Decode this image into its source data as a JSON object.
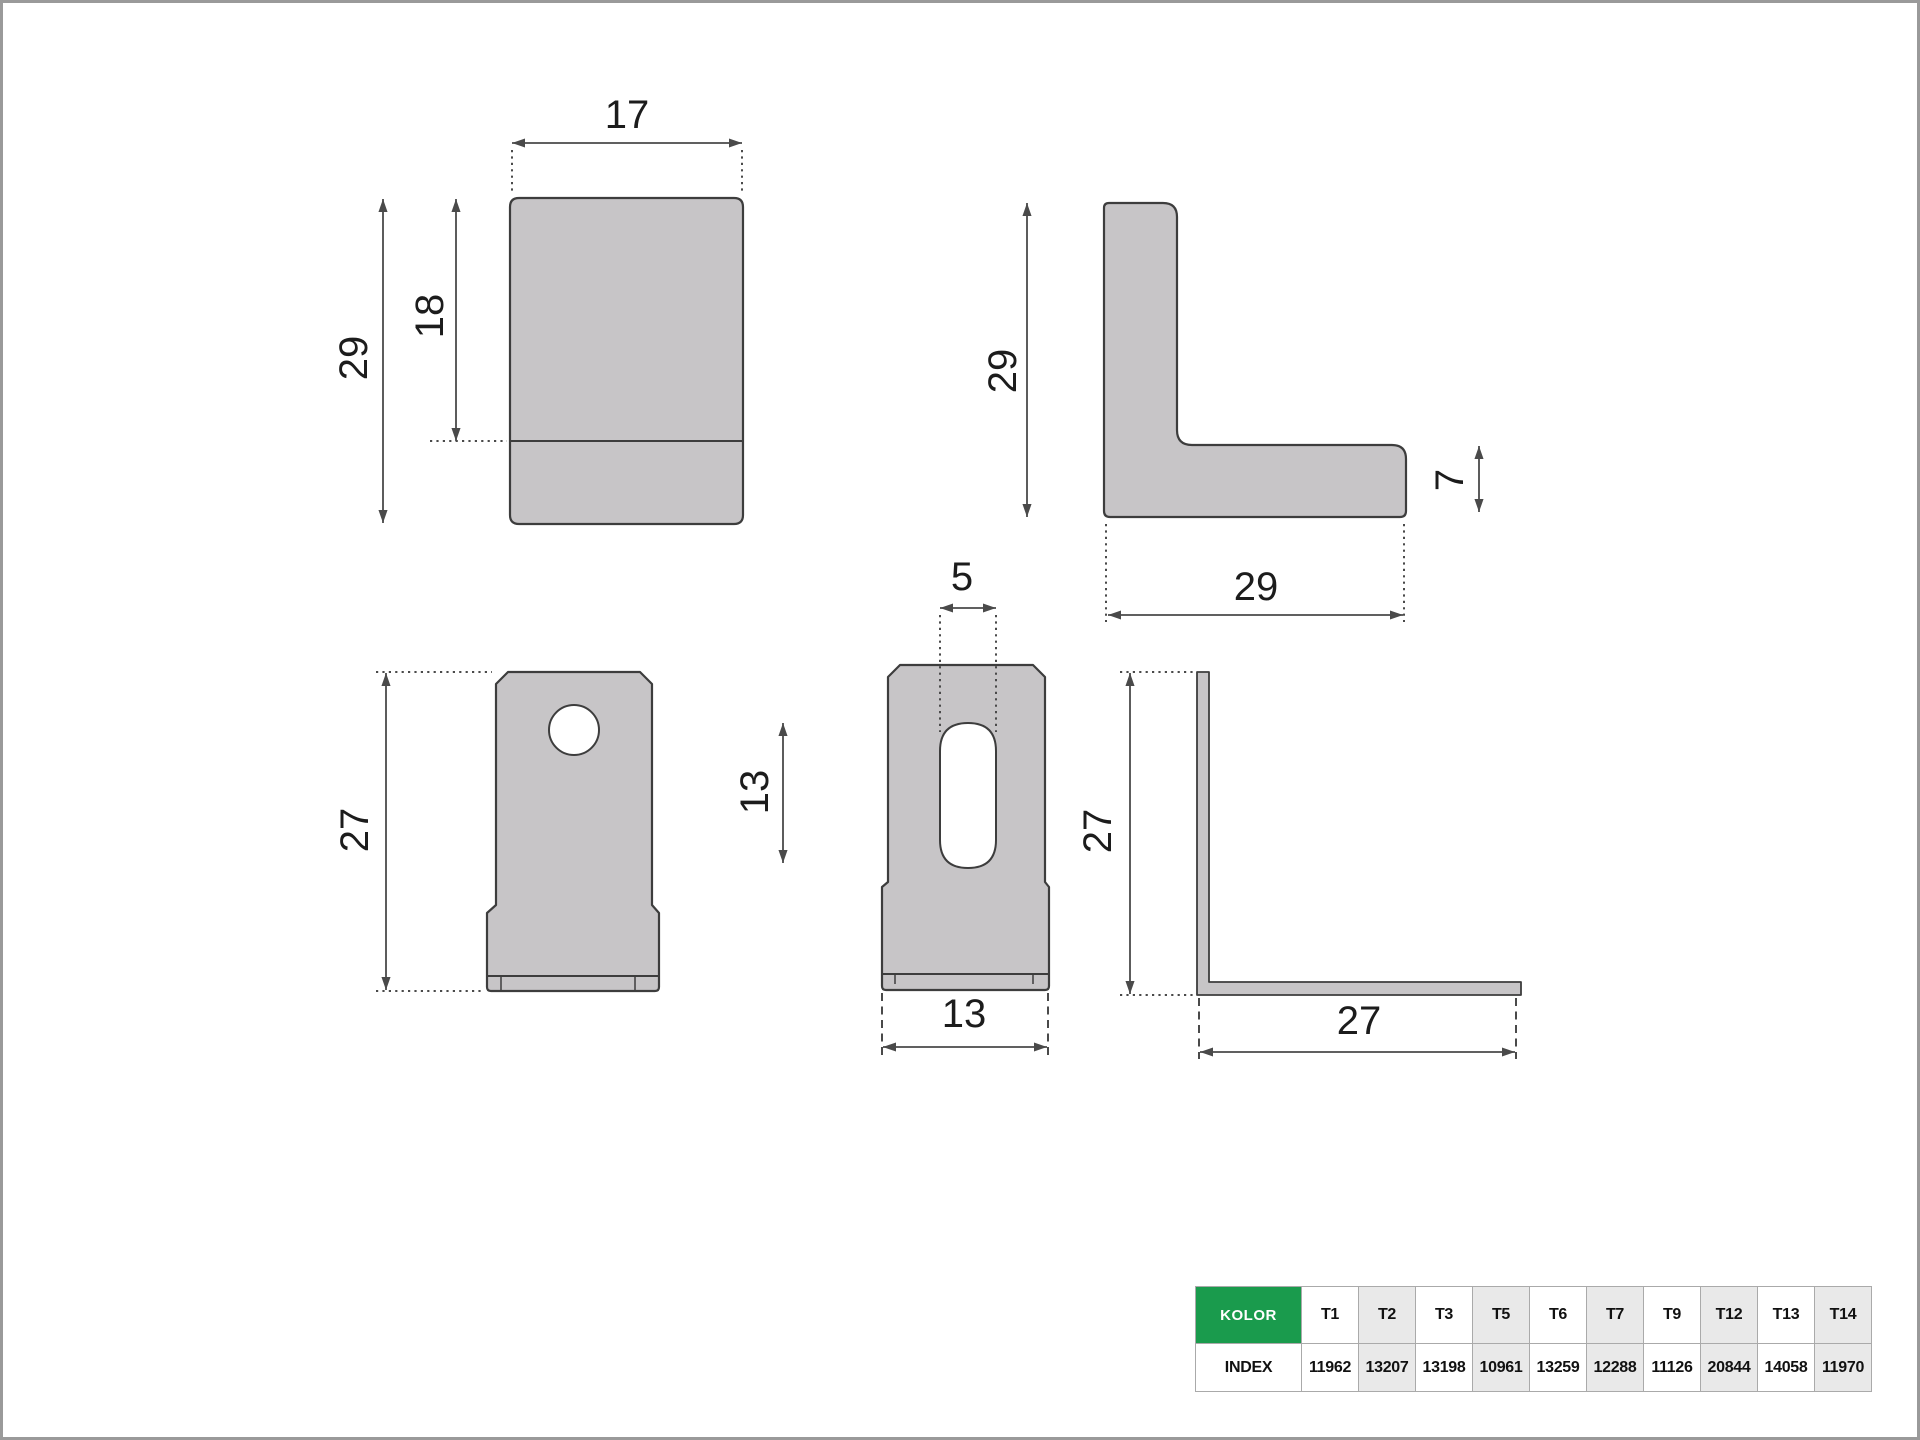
{
  "theme": {
    "canvas_border": "#9a9a9a",
    "shape_fill": "#c7c5c7",
    "shape_stroke": "#3d3d3d",
    "dim_color": "#4a4a4a",
    "text_color": "#1c1c1c",
    "table": {
      "header_bg": "#1a9b4d",
      "header_text": "#ffffff",
      "border": "#aaaaaa",
      "shaded_bg": "#e9e9e9",
      "text": "#111111"
    }
  },
  "drawing": {
    "views": {
      "front_top": {
        "width": "17",
        "total_height": "29",
        "upper_height": "18"
      },
      "side_top": {
        "height": "29",
        "base_width": "29",
        "thickness": "7"
      },
      "front_tab": {
        "height": "27"
      },
      "front_tab_slot": {
        "slot_width": "5",
        "slot_length": "13",
        "tab_width": "13"
      },
      "side_tab": {
        "height": "27",
        "base_width": "27"
      }
    }
  },
  "table": {
    "kolor_label": "KOLOR",
    "index_label": "INDEX",
    "columns": [
      {
        "code": "T1",
        "index": "11962"
      },
      {
        "code": "T2",
        "index": "13207"
      },
      {
        "code": "T3",
        "index": "13198"
      },
      {
        "code": "T5",
        "index": "10961"
      },
      {
        "code": "T6",
        "index": "13259"
      },
      {
        "code": "T7",
        "index": "12288"
      },
      {
        "code": "T9",
        "index": "11126"
      },
      {
        "code": "T12",
        "index": "20844"
      },
      {
        "code": "T13",
        "index": "14058"
      },
      {
        "code": "T14",
        "index": "11970"
      }
    ]
  }
}
